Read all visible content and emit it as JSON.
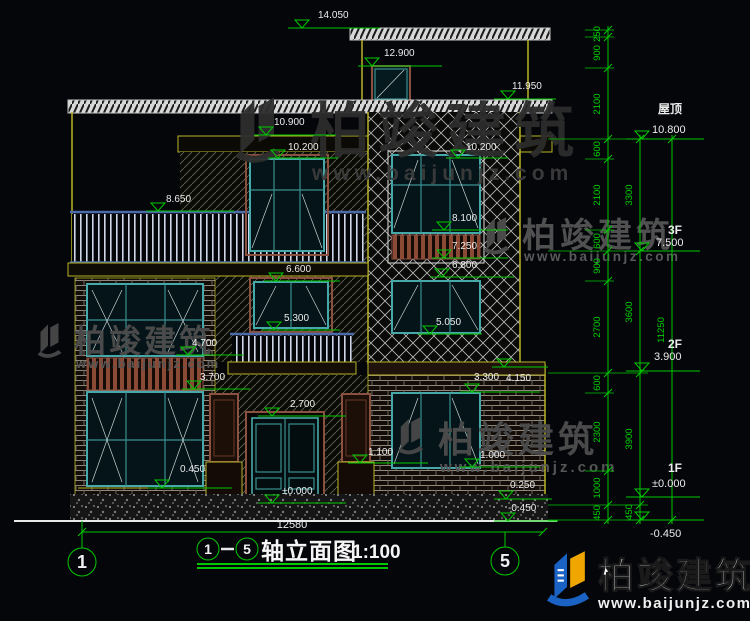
{
  "watermark": {
    "brand": "柏竣建筑",
    "url": "www.baijunjz.com"
  },
  "logo": {
    "brand": "柏竣建筑",
    "url": "www.baijunjz.com"
  },
  "title": {
    "axis_start": "1",
    "axis_end": "5",
    "name": "轴立面图",
    "scale": "1:100"
  },
  "axis_bubbles": {
    "left": "1",
    "right": "5"
  },
  "bottom_dim": "12580",
  "levels": [
    {
      "name": "屋顶",
      "value": "10.800"
    },
    {
      "name": "3F",
      "value": "7.500"
    },
    {
      "name": "2F",
      "value": "3.900"
    },
    {
      "name": "1F",
      "value": "±0.000"
    },
    {
      "name": "",
      "value": "-0.450"
    }
  ],
  "markers": [
    {
      "v": "14.050"
    },
    {
      "v": "12.900"
    },
    {
      "v": "11.950"
    },
    {
      "v": "10.900"
    },
    {
      "v": "10.200"
    },
    {
      "v": "10.200"
    },
    {
      "v": "8.650"
    },
    {
      "v": "8.100"
    },
    {
      "v": "7.250"
    },
    {
      "v": "6.800"
    },
    {
      "v": "6.600"
    },
    {
      "v": "5.300"
    },
    {
      "v": "5.050"
    },
    {
      "v": "4.700"
    },
    {
      "v": "3.700"
    },
    {
      "v": "4.150"
    },
    {
      "v": "3.300"
    },
    {
      "v": "2.700"
    },
    {
      "v": "1.100"
    },
    {
      "v": "1.000"
    },
    {
      "v": "0.450"
    },
    {
      "v": "0.250"
    },
    {
      "v": "±0.000"
    },
    {
      "v": "-0.450"
    }
  ],
  "dims_inner": [
    "250",
    "900",
    "2100",
    "600",
    "2100",
    "600",
    "900",
    "2700",
    "600",
    "2300",
    "1000",
    "450"
  ],
  "dims_mid": [
    "3300",
    "3600",
    "3900",
    "450"
  ],
  "dims_outer": [
    "11250"
  ],
  "colors": {
    "dim_green": "#00c800",
    "wall_yellow": "#b8b428",
    "frame_teal": "#46a8a8",
    "logo_blue": "#1a63c4",
    "logo_yellow": "#f0a500"
  }
}
